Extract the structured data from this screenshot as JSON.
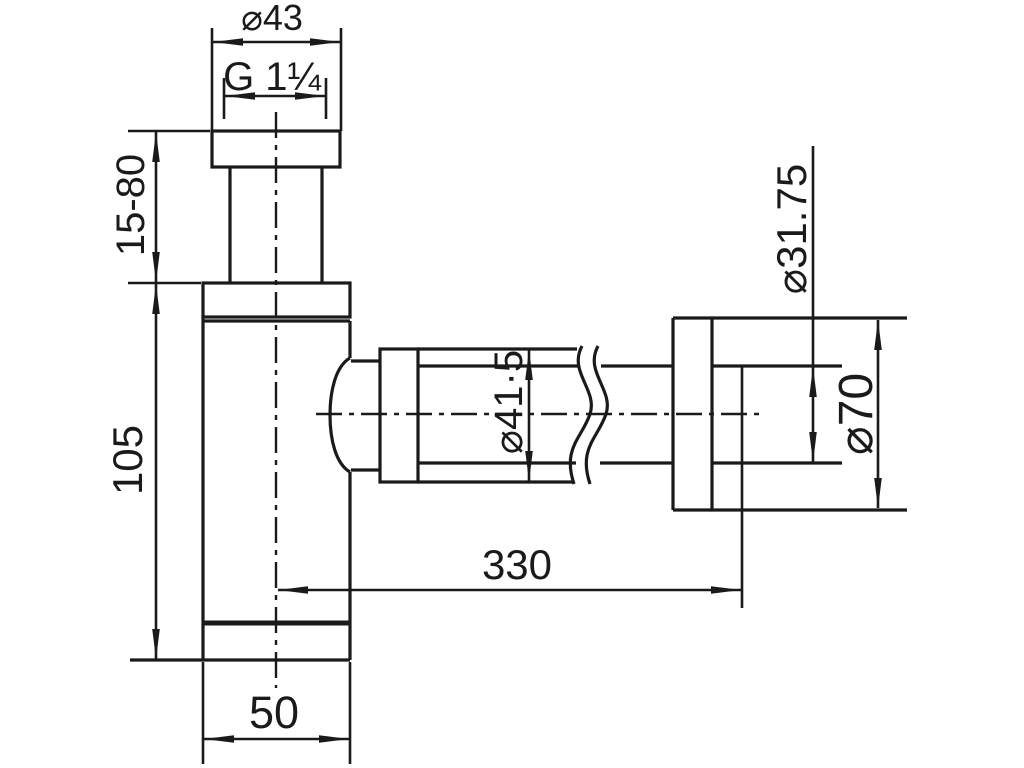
{
  "drawing": {
    "background_color": "#ffffff",
    "line_color": "#1a1a1a",
    "labels": {
      "top_diameter": "⌀43",
      "thread_size": "G 1¼",
      "inlet_height_range": "15-80",
      "body_height": "105",
      "nut_diameter": "⌀41·5",
      "wall_pipe_diameter": "⌀31.75",
      "flange_diameter": "⌀70",
      "horizontal_length": "330",
      "body_width": "50"
    }
  }
}
